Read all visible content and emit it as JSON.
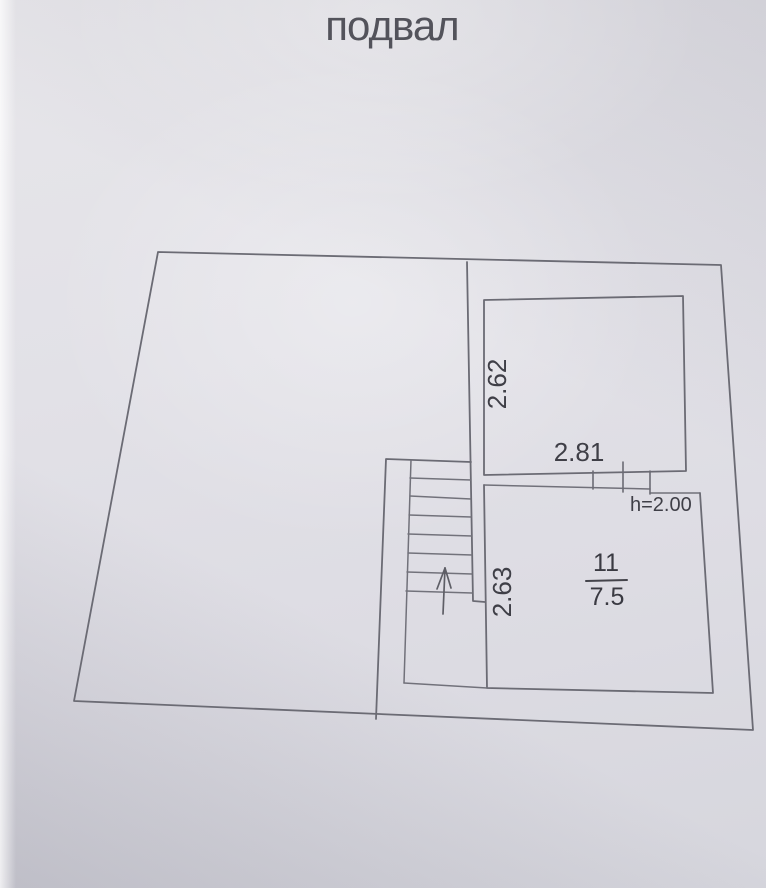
{
  "title": "подвал",
  "plan": {
    "upper_room": {
      "side_dimension": "2.62",
      "bottom_dimension": "2.81"
    },
    "room_11": {
      "number": "11",
      "area": "7.5",
      "side_dimension": "2.63",
      "height_note": "h=2.00"
    }
  },
  "colors": {
    "paper": "#e0dfe5",
    "line": "#6b6b74",
    "text": "#3f3f47"
  }
}
